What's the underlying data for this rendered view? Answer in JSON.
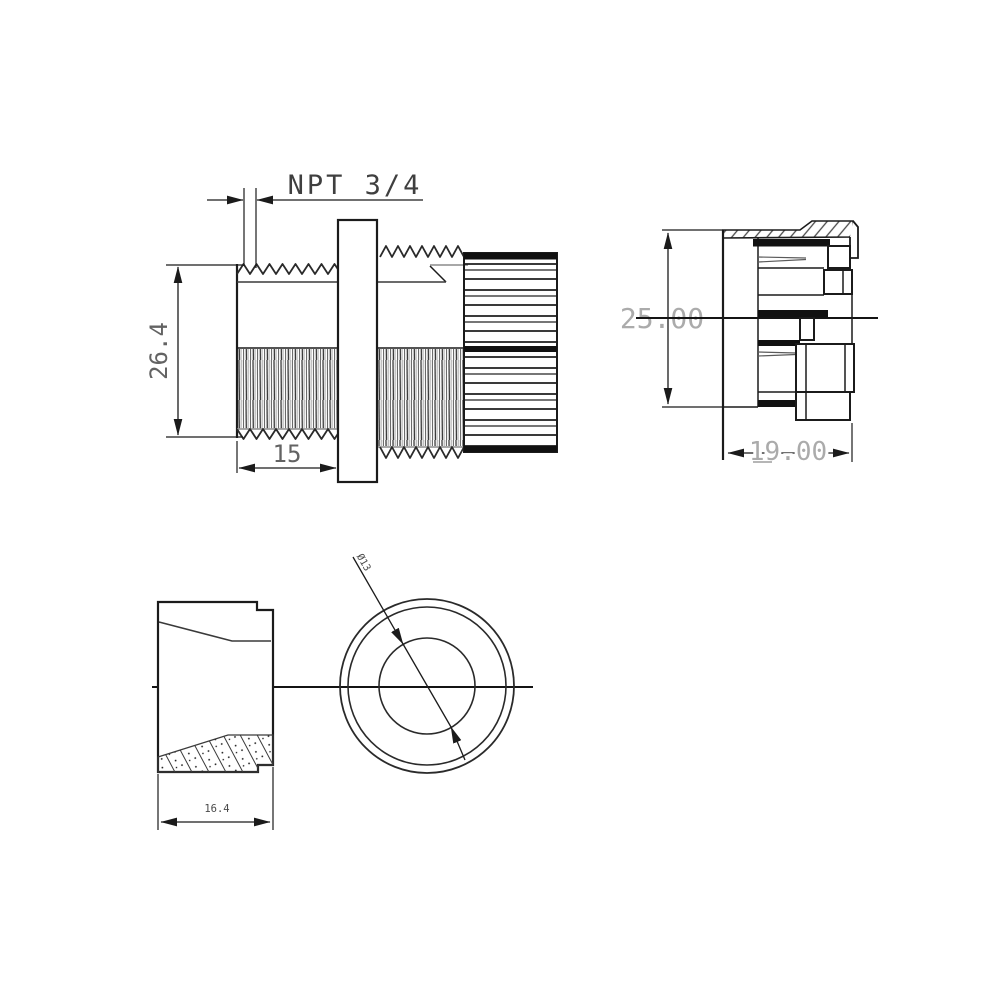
{
  "drawing": {
    "type": "engineering-drawing",
    "subject": "cable-gland",
    "colors": {
      "background": "#ffffff",
      "line": "#1b1b1b",
      "dim_text_dark": "#3f3f3f",
      "dim_text_medium": "#636363",
      "dim_text_light": "#ababab",
      "small_text": "#4a4a4a"
    },
    "views": {
      "gland_side": {
        "thread_spec": "NPT 3/4",
        "dim_height": "26.4",
        "dim_thread_length": "15"
      },
      "insert_side": {
        "dim_height": "25.00",
        "dim_width": "19.00"
      },
      "locknut_section": {
        "dim_width": "16.4"
      },
      "front": {
        "dim_inner_diameter": "Ø13"
      }
    }
  }
}
